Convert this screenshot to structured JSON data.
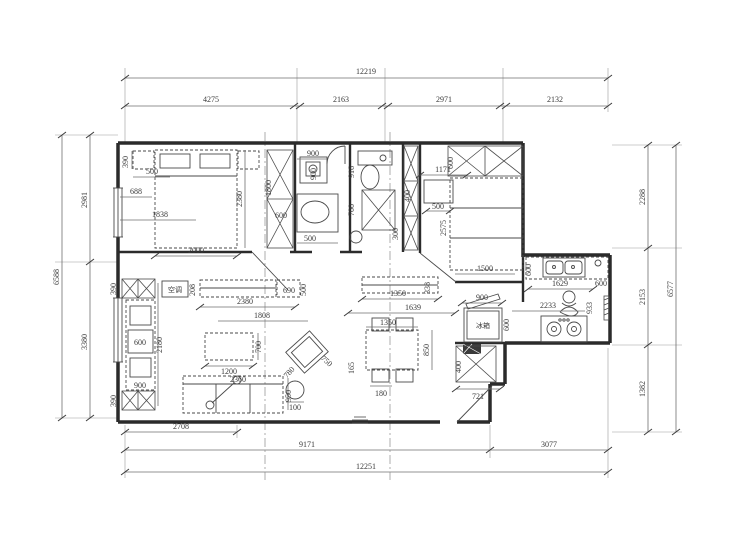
{
  "meta": {
    "type": "floor-plan",
    "units": "mm",
    "ink_color": "#3a3a3a",
    "wall_color": "#2b2b2b"
  },
  "dims": {
    "top": {
      "overall": "12219",
      "chain": [
        "4275",
        "2163",
        "2971",
        "2132"
      ]
    },
    "left": {
      "overall": "6588",
      "chain": [
        "2981",
        "3380"
      ]
    },
    "right": {
      "overall": "6577",
      "chain": [
        "2288",
        "2153",
        "1382"
      ]
    },
    "bottom": {
      "overall": "12251",
      "chain": [
        "9171",
        "3077"
      ],
      "inner": "2708"
    }
  },
  "rooms": {
    "bedroom1": {
      "d390": "390",
      "d500": "500",
      "d688": "688",
      "d1838": "1838",
      "bed_w": "2000",
      "bed_h": "2380",
      "ward_h": "1800",
      "ward_d": "600"
    },
    "bath": {
      "d900a": "900",
      "d900b": "900",
      "d500": "500"
    },
    "wc": {
      "d916": "916",
      "d700": "700",
      "d300": "300"
    },
    "hall": {
      "d400": "400"
    },
    "bedroom2": {
      "d1171": "1171",
      "d500": "500",
      "ward_d": "600",
      "bed_h": "2575",
      "bed_w": "1500"
    },
    "kitchen": {
      "d600a": "600",
      "d1629": "1629",
      "d600b": "600",
      "d933": "933",
      "d2233": "2233"
    },
    "entry": {
      "d900": "900",
      "d600": "600",
      "d400": "400",
      "d721": "721",
      "fridge_label": "冰箱"
    },
    "dining": {
      "d1350a": "1350",
      "d338": "338",
      "d1639": "1639",
      "d1350b": "1350",
      "d850": "850",
      "d165": "165",
      "d180": "180"
    },
    "living": {
      "ac_label": "空调",
      "d208": "208",
      "d2380": "2380",
      "d690": "690",
      "d500": "500",
      "d1808": "1808",
      "d1200": "1200",
      "d700": "700",
      "d2360": "2360",
      "d950": "950",
      "d780": "780",
      "d750": "750",
      "d100": "100",
      "d600": "600",
      "d900": "900",
      "d2180": "2180",
      "d390a": "390",
      "d390b": "390"
    }
  }
}
